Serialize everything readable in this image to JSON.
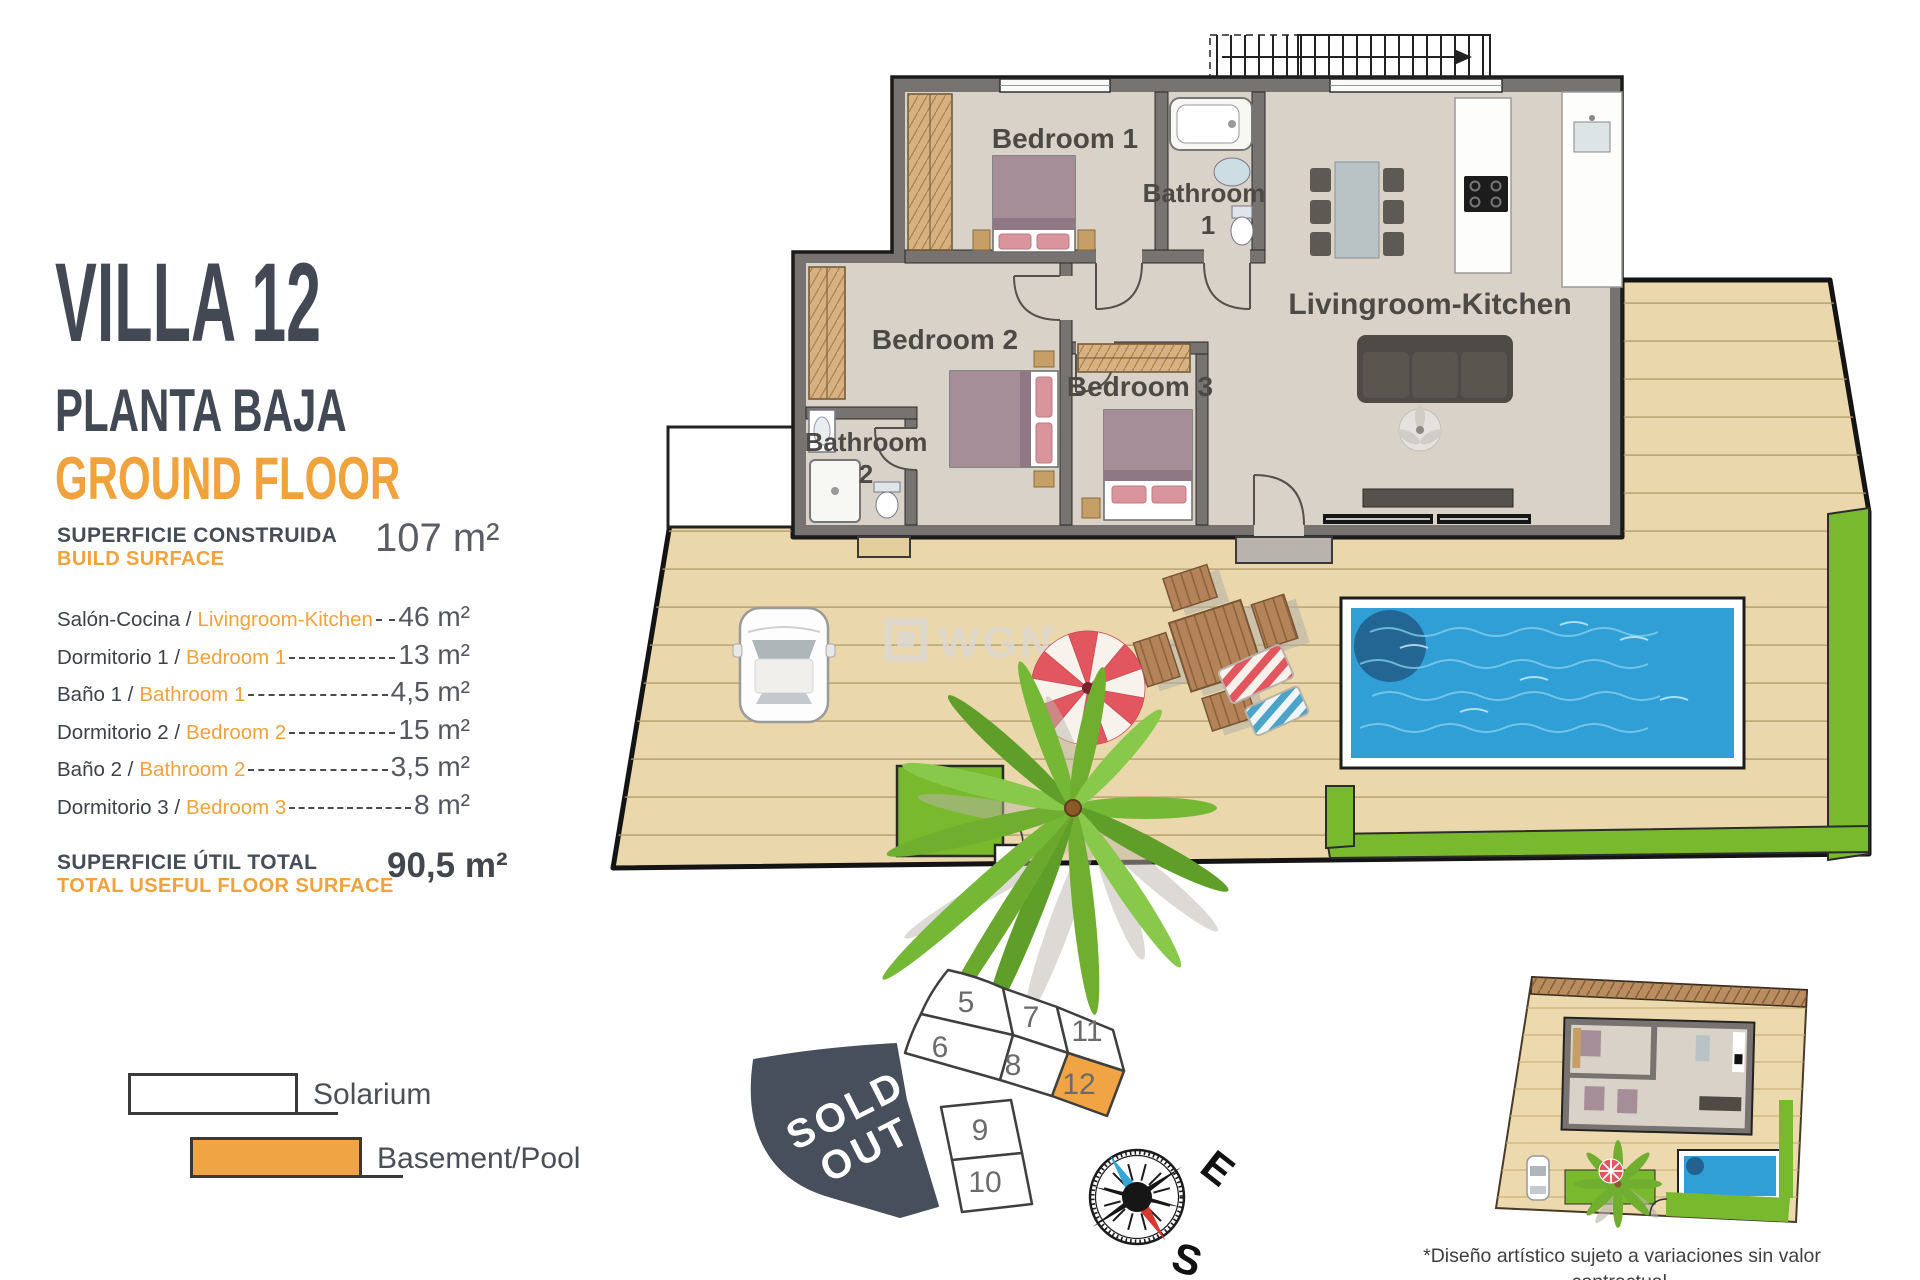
{
  "panel": {
    "title": "VILLA 12",
    "floor_label_es": "PLANTA BAJA",
    "floor_label_en": "GROUND FLOOR",
    "build_surface_label_es": "SUPERFICIE CONSTRUIDA",
    "build_surface_label_en": "BUILD SURFACE",
    "build_surface_value": "107 m²",
    "rooms": [
      {
        "label_es": "Salón-Cocina /",
        "label_en": "Livingroom-Kitchen",
        "value": "46 m²"
      },
      {
        "label_es": "Dormitorio 1 /",
        "label_en": "Bedroom 1",
        "value": "13 m²"
      },
      {
        "label_es": "Baño 1 /",
        "label_en": "Bathroom 1",
        "value": "4,5 m²"
      },
      {
        "label_es": "Dormitorio 2 /",
        "label_en": "Bedroom 2",
        "value": "15 m²"
      },
      {
        "label_es": "Baño 2 /",
        "label_en": "Bathroom 2",
        "value": "3,5 m²"
      },
      {
        "label_es": "Dormitorio 3 /",
        "label_en": "Bedroom 3",
        "value": "8 m²"
      }
    ],
    "total_label_es": "SUPERFICIE ÚTIL TOTAL",
    "total_label_en": "TOTAL USEFUL FLOOR SURFACE",
    "total_value": "90,5 m²"
  },
  "legend": {
    "solarium_label": "Solarium",
    "basement_label": "Basement/Pool"
  },
  "floorplan": {
    "labels": {
      "bedroom1": "Bedroom 1",
      "bathroom1_line1": "Bathroom",
      "bathroom1_line2": "1",
      "livingroom": "Livingroom-Kitchen",
      "bedroom2": "Bedroom 2",
      "bedroom3": "Bedroom 3",
      "bathroom2_line1": "Bathroom",
      "bathroom2_line2": "2"
    }
  },
  "watermark": {
    "text": "WGN",
    "mark": "®"
  },
  "plot_map": {
    "plots": {
      "p5": "5",
      "p6": "6",
      "p7": "7",
      "p8": "8",
      "p9": "9",
      "p10": "10",
      "p11": "11",
      "p12": "12"
    },
    "sold_out_line1": "SOLD",
    "sold_out_line2": "OUT",
    "highlighted_plot": "12"
  },
  "compass": {
    "east_label": "E",
    "south_label": "S"
  },
  "disclaimer": {
    "line1": "*Diseño artístico sujeto a variaciones sin valor contractual.",
    "line2": "Muebles y paneles solares no incluidos."
  },
  "colors": {
    "accent_orange": "#F0A23C",
    "legend_orange": "#F0A444",
    "dark_navy": "#474E5C",
    "grass_green": "#79B92E",
    "pool_blue": "#2F9FD6",
    "deck_tan": "#EAD8AC"
  }
}
